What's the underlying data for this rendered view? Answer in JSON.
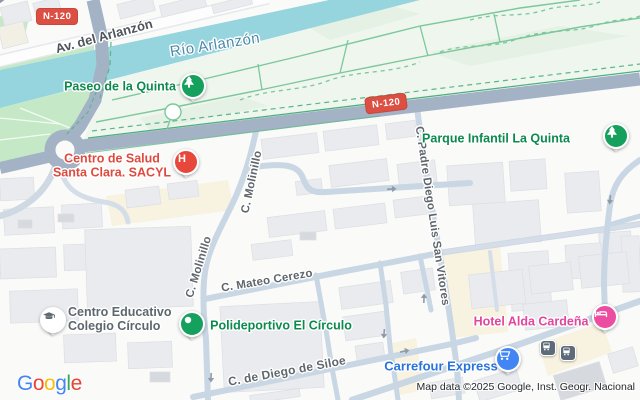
{
  "badges": {
    "nw": "N-120",
    "mid": "N-120"
  },
  "water": {
    "river": "Río Arlanzón"
  },
  "streets": {
    "av_arlanzon": "Av. del Arlanzón",
    "molinillo_a": "C. Molinillo",
    "molinillo_b": "C. Molinillo",
    "mateo_cerezo": "C. Mateo Cerezo",
    "padre_diego": "C. Padre Diego Luis San Vitores",
    "diego_siloe": "C. de Diego de Siloe"
  },
  "pois": {
    "paseo": {
      "label": "Paseo de la Quinta",
      "icon": "tree"
    },
    "parque_infantil": {
      "label": "Parque Infantil La Quinta",
      "icon": "tree"
    },
    "salud": {
      "line1": "Centro de Salud",
      "line2": "Santa Clara. SACYL",
      "icon": "hospital-h",
      "icon_letter": "H"
    },
    "colegio": {
      "line1": "Centro Educativo",
      "line2": "Colegio Círculo",
      "icon": "graduation-cap"
    },
    "polideportivo": {
      "label": "Polideportivo El Círculo",
      "icon": "dot"
    },
    "hotel": {
      "label": "Hotel Alda Cardeña",
      "icon": "bed"
    },
    "carrefour": {
      "label": "Carrefour Express",
      "icon": "shopping-cart"
    }
  },
  "transit": {
    "bus_stops": [
      "bus-stop",
      "bus-stop"
    ]
  },
  "footer": {
    "logo": {
      "g1": "G",
      "o1": "o",
      "o2": "o",
      "g2": "g",
      "l1": "l",
      "e1": "e"
    },
    "attribution": "Map data ©2025 Google, Inst. Geogr. Nacional"
  },
  "colors": {
    "river": "#96d5de",
    "major_road": "#a3b2c5",
    "minor_road": "#c9d6e3",
    "park_green": "#c5e8c6",
    "park_pale": "#eef6ee",
    "building": "#e9ebee",
    "commercial": "#f8f2e0",
    "poi_green": "#0c8a4e",
    "poi_red": "#df4a3f",
    "poi_pink": "#e2459c",
    "poi_blue": "#2a73dd",
    "badge_red": "#dc4f43",
    "pin_green": "#16a05d",
    "pin_red": "#e8483c",
    "pin_pink": "#ec4da1",
    "pin_blue": "#4285f4",
    "bus_gray": "#5d6b79"
  }
}
